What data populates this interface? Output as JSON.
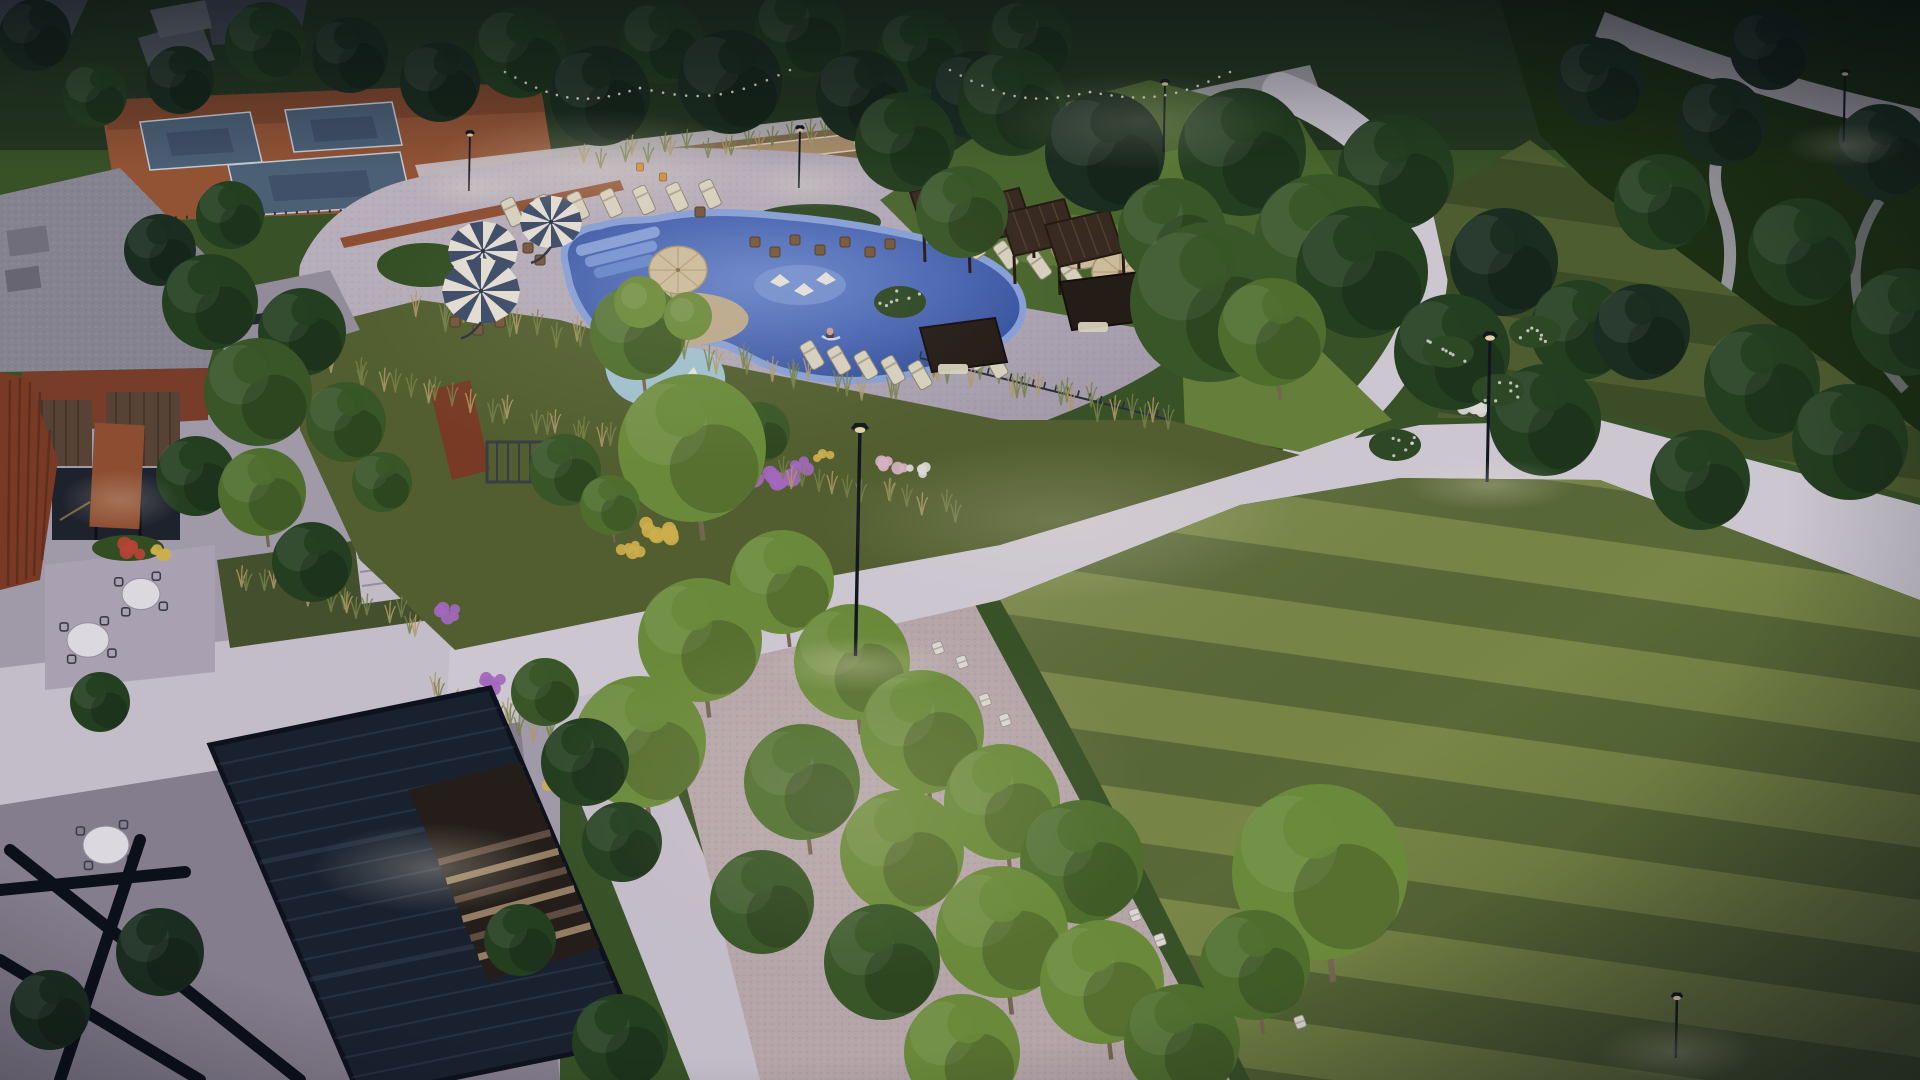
{
  "scene_type": "architectural-dusk-rendering-community-park",
  "colors": {
    "base_green": "#3a5424",
    "dusk_green": "#24381c",
    "park_dark": "#1b300f",
    "lawn_light": "#7e8e46",
    "lawn_dark": "#5d6e35",
    "lawn_lit": "#6a8538",
    "upper_lawn": "#4c6a2c",
    "path": "#d8d2da",
    "deck": "#b7aeba",
    "plaza": "#a9a2ae",
    "plaza_dark": "#8b8492",
    "walkway": "#cfc8d2",
    "gravel_grove": "#c0afb0",
    "bocce": "#b5996f",
    "bocce_base": "#8a6f4e",
    "pool_deep": "#33519e",
    "pool_mid": "#5d7ec9",
    "pool_rim": "#8ea8e0",
    "pool_steps": "#7e9cdc",
    "lagoon": "#a9cbd8",
    "island_sand": "#c6b190",
    "court_blue": "#4e6378",
    "court_inner": "#42536a",
    "court_line": "#cfd8df",
    "clay": "#9a5733",
    "clay_dark": "#7c4527",
    "brick": "#7e3e28",
    "brick_light": "#95502f",
    "corten": "#7e3c22",
    "roof_gravel": "#8d8a95",
    "wood_slat": "#5a4534",
    "window_dark": "#1d222b",
    "pergola_navy": "#18212d",
    "pergola_brown": "#3a2b1d",
    "umbrella_white": "#efe9dc",
    "umbrella_navy": "#3c4c68",
    "umbrella_tan": "#d9c7a2",
    "lounger": "#e4dcc5",
    "adirondack": "#e8e4da",
    "chair_orange": "#d98a2b",
    "trunk": "#7a6a50",
    "grass_olive": "#55622d",
    "grass_wheat": "#b8a268",
    "flower_purple": "#ad6cc4",
    "flower_yellow": "#d9b94c",
    "flower_pink": "#e3bccb",
    "flower_white": "#e9e6df",
    "flower_red": "#bf4733",
    "lamp_black": "#10151c",
    "glow": "#fff3d6",
    "skin": "#d8a894",
    "step_wood": "#9b8463",
    "step_wood_dark": "#645040"
  },
  "scene": {
    "tree_shades": {
      "du": "#1a2e1c",
      "dk": "#24401d",
      "md": "#3a5a24",
      "ml": "#52742c",
      "lt": "#6f9138",
      "li": "#8fae4b"
    },
    "trees": [
      [
        440,
        82,
        40,
        "du"
      ],
      [
        520,
        52,
        46,
        "dk"
      ],
      [
        600,
        96,
        50,
        "du"
      ],
      [
        662,
        42,
        42,
        "dk"
      ],
      [
        730,
        82,
        52,
        "du"
      ],
      [
        800,
        32,
        46,
        "dk"
      ],
      [
        862,
        96,
        46,
        "du"
      ],
      [
        920,
        52,
        42,
        "dk"
      ],
      [
        350,
        55,
        38,
        "du"
      ],
      [
        265,
        42,
        40,
        "dk"
      ],
      [
        180,
        80,
        34,
        "du"
      ],
      [
        95,
        95,
        32,
        "dk"
      ],
      [
        35,
        35,
        36,
        "du"
      ],
      [
        975,
        95,
        44,
        "du"
      ],
      [
        1030,
        40,
        42,
        "dk"
      ],
      [
        905,
        142,
        50,
        "dk"
      ],
      [
        962,
        212,
        46,
        "md"
      ],
      [
        1012,
        102,
        54,
        "dk"
      ],
      [
        1105,
        152,
        60,
        "du"
      ],
      [
        1172,
        232,
        54,
        "md"
      ],
      [
        1242,
        152,
        64,
        "dk"
      ],
      [
        1322,
        242,
        68,
        "md"
      ],
      [
        1396,
        172,
        58,
        "dk"
      ],
      [
        1272,
        332,
        54,
        "ml"
      ],
      [
        1210,
        302,
        80,
        "md"
      ],
      [
        1362,
        272,
        66,
        "dk"
      ],
      [
        1452,
        352,
        58,
        "dk"
      ],
      [
        1504,
        262,
        54,
        "du"
      ],
      [
        1545,
        420,
        56,
        "dk"
      ],
      [
        1580,
        330,
        50,
        "dk"
      ],
      [
        1600,
        82,
        44,
        "du"
      ],
      [
        1662,
        202,
        48,
        "dk"
      ],
      [
        1722,
        122,
        44,
        "du"
      ],
      [
        1802,
        252,
        54,
        "dk"
      ],
      [
        1882,
        152,
        48,
        "du"
      ],
      [
        1905,
        322,
        54,
        "dk"
      ],
      [
        1762,
        382,
        58,
        "dk"
      ],
      [
        1642,
        332,
        48,
        "du"
      ],
      [
        1850,
        442,
        58,
        "dk"
      ],
      [
        1700,
        480,
        50,
        "dk"
      ],
      [
        1770,
        50,
        40,
        "du"
      ],
      [
        210,
        302,
        48,
        "dk"
      ],
      [
        258,
        392,
        54,
        "md"
      ],
      [
        302,
        332,
        44,
        "dk"
      ],
      [
        346,
        422,
        40,
        "md"
      ],
      [
        196,
        476,
        40,
        "dk"
      ],
      [
        262,
        492,
        44,
        "ml"
      ],
      [
        312,
        562,
        40,
        "dk"
      ],
      [
        382,
        482,
        30,
        "md"
      ],
      [
        160,
        250,
        36,
        "du"
      ],
      [
        230,
        215,
        34,
        "dk"
      ],
      [
        638,
        332,
        48,
        "ml"
      ],
      [
        692,
        448,
        74,
        "lt"
      ],
      [
        760,
        432,
        30,
        "md"
      ],
      [
        565,
        470,
        36,
        "md"
      ],
      [
        610,
        505,
        30,
        "ml"
      ],
      [
        700,
        640,
        62,
        "lt"
      ],
      [
        640,
        742,
        66,
        "lt"
      ],
      [
        782,
        582,
        52,
        "lt"
      ],
      [
        852,
        662,
        58,
        "lt"
      ],
      [
        922,
        732,
        62,
        "lt"
      ],
      [
        802,
        782,
        58,
        "ml"
      ],
      [
        902,
        852,
        62,
        "lt"
      ],
      [
        1002,
        802,
        58,
        "lt"
      ],
      [
        1082,
        862,
        62,
        "ml"
      ],
      [
        1002,
        932,
        66,
        "lt"
      ],
      [
        1102,
        982,
        62,
        "lt"
      ],
      [
        1182,
        1042,
        58,
        "ml"
      ],
      [
        882,
        962,
        58,
        "md"
      ],
      [
        762,
        902,
        52,
        "md"
      ],
      [
        962,
        1052,
        58,
        "lt"
      ],
      [
        1320,
        872,
        88,
        "lt"
      ],
      [
        1255,
        965,
        55,
        "ml"
      ],
      [
        585,
        762,
        44,
        "dk"
      ],
      [
        545,
        692,
        34,
        "md"
      ],
      [
        622,
        842,
        40,
        "dk"
      ],
      [
        160,
        952,
        44,
        "du"
      ],
      [
        100,
        702,
        30,
        "dk"
      ],
      [
        620,
        1042,
        48,
        "dk"
      ],
      [
        50,
        1010,
        40,
        "du"
      ],
      [
        520,
        940,
        36,
        "dk"
      ]
    ],
    "island_trees": [
      [
        640,
        302,
        26
      ],
      [
        688,
        316,
        24
      ]
    ],
    "bushes": [
      [
        1448,
        352
      ],
      [
        1498,
        390
      ],
      [
        1535,
        332
      ],
      [
        900,
        302
      ],
      [
        1395,
        445
      ]
    ],
    "lamps": [
      [
        860,
        428,
        228,
        1.0
      ],
      [
        1490,
        336,
        146,
        0.9
      ],
      [
        1165,
        82,
        70,
        0.6
      ],
      [
        1845,
        72,
        70,
        0.6
      ],
      [
        800,
        128,
        60,
        0.55
      ],
      [
        470,
        133,
        58,
        0.55
      ],
      [
        1677,
        996,
        62,
        0.7
      ]
    ],
    "striped_umbrellas": [
      [
        551,
        222,
        31
      ],
      [
        483,
        251,
        35
      ],
      [
        481,
        291,
        39
      ]
    ],
    "tan_umbrellas": [
      [
        678,
        270,
        29
      ],
      [
        1080,
        245,
        29
      ],
      [
        1120,
        272,
        28
      ]
    ],
    "lounger_rows": [
      {
        "x": 512,
        "y": 212,
        "n": 7,
        "dx": 33,
        "dy": -3,
        "a": -25
      },
      {
        "x": 940,
        "y": 235,
        "n": 6,
        "dx": 33,
        "dy": 10,
        "a": -35
      },
      {
        "x": 812,
        "y": 355,
        "n": 5,
        "dx": 27,
        "dy": 5,
        "a": -30
      },
      {
        "x": 952,
        "y": 348,
        "n": 3,
        "dx": 22,
        "dy": 8,
        "a": -30
      },
      {
        "x": 645,
        "y": 300,
        "n": 2,
        "dx": 24,
        "dy": 6,
        "a": -30
      }
    ],
    "red_loungers": [
      [
        660,
        302
      ]
    ],
    "side_tables": [
      [
        755,
        242
      ],
      [
        775,
        252
      ],
      [
        795,
        240
      ],
      [
        820,
        250
      ],
      [
        845,
        242
      ],
      [
        870,
        252
      ],
      [
        890,
        244
      ],
      [
        528,
        248
      ],
      [
        540,
        260
      ],
      [
        700,
        212
      ],
      [
        455,
        322
      ],
      [
        478,
        330
      ],
      [
        500,
        322
      ]
    ],
    "round_tables": [
      [
        141,
        594,
        19
      ],
      [
        88,
        640,
        21
      ],
      [
        106,
        845,
        23
      ]
    ],
    "grove_tables": [
      [
        810,
        618
      ],
      [
        900,
        690
      ],
      [
        786,
        826
      ]
    ],
    "orange_chairs": [
      [
        800,
        612
      ],
      [
        860,
        612
      ],
      [
        912,
        683
      ],
      [
        773,
        757
      ],
      [
        775,
        820
      ],
      [
        795,
        833
      ],
      [
        640,
        167
      ],
      [
        663,
        177
      ],
      [
        845,
        640
      ],
      [
        880,
        700
      ]
    ],
    "white_chairs": [
      [
        938,
        648
      ],
      [
        962,
        662
      ],
      [
        985,
        700
      ],
      [
        1005,
        720
      ],
      [
        1018,
        768
      ],
      [
        1040,
        790
      ],
      [
        1070,
        830
      ],
      [
        1090,
        855
      ],
      [
        1270,
        1002
      ],
      [
        1300,
        1022
      ],
      [
        1135,
        915
      ],
      [
        1160,
        940
      ]
    ],
    "pergola_canopies": [
      [
        910,
        192
      ],
      [
        955,
        203
      ],
      [
        1000,
        214
      ],
      [
        1045,
        225
      ]
    ],
    "people": [
      [
        423,
        852
      ],
      [
        467,
        852
      ],
      [
        830,
        333
      ],
      [
        795,
        612
      ]
    ],
    "string_lights": [
      {
        "x1": 505,
        "y1": 72,
        "x2": 640,
        "y2": 88,
        "sag": 18
      },
      {
        "x1": 640,
        "y1": 88,
        "x2": 790,
        "y2": 70,
        "sag": 16
      },
      {
        "x1": 950,
        "y1": 70,
        "x2": 1090,
        "y2": 92,
        "sag": 16
      },
      {
        "x1": 1090,
        "y1": 92,
        "x2": 1230,
        "y2": 72,
        "sag": 14
      }
    ],
    "flower_patches": [
      {
        "x": 775,
        "y": 480,
        "r": 20,
        "c": "flower_purple",
        "n": 7
      },
      {
        "x": 802,
        "y": 466,
        "r": 12,
        "c": "flower_purple",
        "n": 5
      },
      {
        "x": 895,
        "y": 462,
        "r": 14,
        "c": "flower_pink",
        "n": 6
      },
      {
        "x": 917,
        "y": 470,
        "r": 10,
        "c": "flower_white",
        "n": 5
      },
      {
        "x": 826,
        "y": 458,
        "r": 9,
        "c": "flower_yellow",
        "n": 4
      },
      {
        "x": 655,
        "y": 530,
        "r": 18,
        "c": "flower_yellow",
        "n": 7
      },
      {
        "x": 630,
        "y": 547,
        "r": 12,
        "c": "flower_yellow",
        "n": 5
      },
      {
        "x": 490,
        "y": 685,
        "r": 14,
        "c": "flower_purple",
        "n": 6
      },
      {
        "x": 552,
        "y": 782,
        "r": 11,
        "c": "flower_yellow",
        "n": 5
      },
      {
        "x": 572,
        "y": 750,
        "r": 11,
        "c": "flower_purple",
        "n": 5
      },
      {
        "x": 128,
        "y": 548,
        "r": 13,
        "c": "flower_red",
        "n": 6
      },
      {
        "x": 158,
        "y": 554,
        "r": 10,
        "c": "flower_yellow",
        "n": 4
      },
      {
        "x": 445,
        "y": 612,
        "r": 12,
        "c": "flower_purple",
        "n": 5
      },
      {
        "x": 1475,
        "y": 408,
        "r": 12,
        "c": "flower_white",
        "n": 6
      },
      {
        "x": 1548,
        "y": 372,
        "r": 10,
        "c": "flower_white",
        "n": 5
      }
    ],
    "grass_bands": [
      {
        "x1": 340,
        "y1": 380,
        "x2": 700,
        "y2": 470,
        "n": 26,
        "len": 16
      },
      {
        "x1": 700,
        "y1": 470,
        "x2": 960,
        "y2": 520,
        "n": 18,
        "len": 15
      },
      {
        "x1": 420,
        "y1": 320,
        "x2": 900,
        "y2": 400,
        "n": 30,
        "len": 18
      },
      {
        "x1": 930,
        "y1": 375,
        "x2": 1165,
        "y2": 430,
        "n": 20,
        "len": 17
      },
      {
        "x1": 240,
        "y1": 585,
        "x2": 420,
        "y2": 630,
        "n": 16,
        "len": 14
      },
      {
        "x1": 430,
        "y1": 700,
        "x2": 560,
        "y2": 745,
        "n": 12,
        "len": 15
      },
      {
        "x1": 590,
        "y1": 165,
        "x2": 860,
        "y2": 135,
        "n": 20,
        "len": 12
      }
    ],
    "glows": [
      [
        1060,
        520,
        240,
        80,
        0.2
      ],
      [
        860,
        665,
        95,
        28,
        0.3
      ],
      [
        1490,
        485,
        85,
        26,
        0.28
      ],
      [
        600,
        165,
        170,
        55,
        0.28
      ],
      [
        1140,
        120,
        150,
        50,
        0.2
      ],
      [
        850,
        800,
        300,
        180,
        0.14
      ],
      [
        432,
        868,
        120,
        45,
        0.3
      ],
      [
        700,
        300,
        380,
        170,
        0.1
      ],
      [
        120,
        500,
        60,
        30,
        0.25
      ],
      [
        1677,
        1052,
        80,
        30,
        0.25
      ],
      [
        1845,
        145,
        60,
        22,
        0.22
      ],
      [
        805,
        185,
        70,
        24,
        0.25
      ],
      [
        472,
        188,
        60,
        20,
        0.25
      ]
    ]
  }
}
